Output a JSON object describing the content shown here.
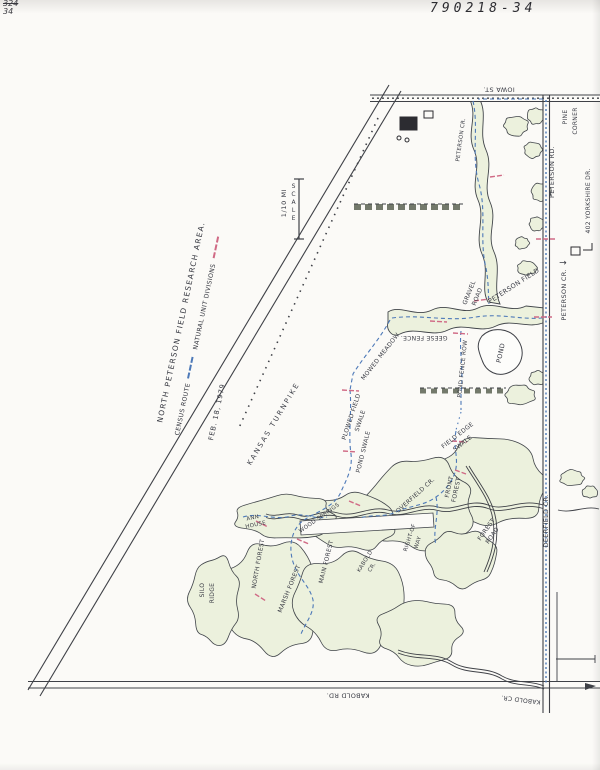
{
  "page": {
    "doc_number": "790218-34",
    "corner_note_line1": "324",
    "corner_note_line2": "34"
  },
  "title_block": {
    "title": "NORTH PETERSON FIELD RESEARCH AREA.",
    "legend": [
      {
        "label": "CENSUS ROUTE",
        "swatch": "census-route-dashed-blue"
      },
      {
        "label": "NATURAL UNIT DIVISIONS",
        "swatch": "natural-unit-dashed-red"
      }
    ],
    "date": "FEB. 18, 1979"
  },
  "scale": {
    "distance": "1/10 MI",
    "label": "SCALE"
  },
  "colors": {
    "census_route": "#4d79b8",
    "natural_unit": "#d06a85",
    "vegetation": "#ecf1dd",
    "ink": "#3f4147",
    "paper": "#fbfaf7"
  },
  "map_labels": [
    {
      "name": "kansas-turnpike-label",
      "text": "KANSAS TURNPIKE",
      "x": 274,
      "y": 424,
      "rot": -59,
      "size": 7,
      "ls": 2
    },
    {
      "name": "iowa-st-label",
      "text": "IOWA ST.",
      "x": 499,
      "y": 89,
      "rot": 180,
      "size": 6.5
    },
    {
      "name": "pine-corner-label-1",
      "text": "PINE",
      "x": 566,
      "y": 117,
      "rot": -90,
      "size": 6
    },
    {
      "name": "pine-corner-label-2",
      "text": "CORNER",
      "x": 576,
      "y": 121,
      "rot": -90,
      "size": 6
    },
    {
      "name": "peterson-rd-label",
      "text": "PETERSON RD.",
      "x": 552,
      "y": 172,
      "rot": -90,
      "size": 6.5
    },
    {
      "name": "yorkshire-address-label",
      "text": "402 YORKSHIRE DR.",
      "x": 589,
      "y": 201,
      "rot": -90,
      "size": 6
    },
    {
      "name": "peterson-cr-label",
      "text": "PETERSON CR.",
      "x": 564,
      "y": 295,
      "rot": -90,
      "size": 6.5
    },
    {
      "name": "peterson-cr-arrow",
      "text": "→",
      "x": 563,
      "y": 264,
      "rot": 0,
      "size": 9
    },
    {
      "name": "peterson-creek-upper-label",
      "text": "PETERSON CR.",
      "x": 462,
      "y": 140,
      "rot": -82,
      "size": 5.5
    },
    {
      "name": "peterson-field-label",
      "text": "PETERSON FIELD",
      "x": 514,
      "y": 286,
      "rot": -33,
      "size": 6.5
    },
    {
      "name": "gravel-road-label-1",
      "text": "GRAVEL",
      "x": 470,
      "y": 293,
      "rot": -68,
      "size": 6
    },
    {
      "name": "gravel-road-label-2",
      "text": "ROAD",
      "x": 478,
      "y": 297,
      "rot": -68,
      "size": 6
    },
    {
      "name": "geese-fence-label",
      "text": "GEESE FENCE.",
      "x": 424,
      "y": 337,
      "rot": 180,
      "size": 6
    },
    {
      "name": "mowed-meadow-label",
      "text": "MOWED MEADOW",
      "x": 381,
      "y": 357,
      "rot": -52,
      "size": 6
    },
    {
      "name": "pond-label",
      "text": "POND",
      "x": 501,
      "y": 353,
      "rot": -78,
      "size": 6.5
    },
    {
      "name": "pond-fence-row-label",
      "text": "POND FENCE ROW",
      "x": 464,
      "y": 369,
      "rot": -84,
      "size": 5.8
    },
    {
      "name": "plowed-field-swale-label-1",
      "text": "PLOWED FIELD",
      "x": 352,
      "y": 417,
      "rot": -72,
      "size": 6
    },
    {
      "name": "plowed-field-swale-label-2",
      "text": "SWALE",
      "x": 361,
      "y": 421,
      "rot": -72,
      "size": 6
    },
    {
      "name": "pond-swale-label",
      "text": "POND SWALE",
      "x": 364,
      "y": 452,
      "rot": -76,
      "size": 6
    },
    {
      "name": "field-edge-swale-label-1",
      "text": "FIELD EDGE",
      "x": 458,
      "y": 436,
      "rot": -38,
      "size": 6
    },
    {
      "name": "field-edge-swale-label-2",
      "text": "SWALE",
      "x": 463,
      "y": 444,
      "rot": -38,
      "size": 6
    },
    {
      "name": "front-forest-label-1",
      "text": "FRONT",
      "x": 450,
      "y": 487,
      "rot": -78,
      "size": 6
    },
    {
      "name": "front-forest-label-2",
      "text": "FOREST",
      "x": 457,
      "y": 490,
      "rot": -78,
      "size": 6
    },
    {
      "name": "overfield-cr-label",
      "text": "OVERFIELD CR.",
      "x": 416,
      "y": 496,
      "rot": -42,
      "size": 6
    },
    {
      "name": "right-of-way-label-1",
      "text": "RIGHT-OF",
      "x": 411,
      "y": 538,
      "rot": -72,
      "size": 5.5
    },
    {
      "name": "right-of-way-label-2",
      "text": "WAY",
      "x": 419,
      "y": 543,
      "rot": -72,
      "size": 5.5
    },
    {
      "name": "forest-road-label-1",
      "text": "FOREST",
      "x": 487,
      "y": 530,
      "rot": -55,
      "size": 6
    },
    {
      "name": "forest-road-label-2",
      "text": "ROAD",
      "x": 493,
      "y": 536,
      "rot": -55,
      "size": 6
    },
    {
      "name": "deerfield-cr-label",
      "text": "DEERFIELD CR.",
      "x": 546,
      "y": 521,
      "rot": -90,
      "size": 6.5
    },
    {
      "name": "kabold-cr-mid-label-1",
      "text": "KABOLD",
      "x": 366,
      "y": 562,
      "rot": -58,
      "size": 5.5
    },
    {
      "name": "kabold-cr-mid-label-2",
      "text": "CR.",
      "x": 373,
      "y": 568,
      "rot": -58,
      "size": 5.5
    },
    {
      "name": "ann-house-label-1",
      "text": "ANN",
      "x": 253,
      "y": 519,
      "rot": -12,
      "size": 5.5
    },
    {
      "name": "ann-house-label-2",
      "text": "HOUSE",
      "x": 256,
      "y": 526,
      "rot": -12,
      "size": 5.5
    },
    {
      "name": "wood-springs-label",
      "text": "WOOD SPRINGS",
      "x": 320,
      "y": 519,
      "rot": -35,
      "size": 5.5
    },
    {
      "name": "north-forest-label",
      "text": "NORTH FOREST",
      "x": 259,
      "y": 564,
      "rot": -80,
      "size": 6
    },
    {
      "name": "marsh-forest-label",
      "text": "MARSH FOREST",
      "x": 290,
      "y": 589,
      "rot": -68,
      "size": 6
    },
    {
      "name": "main-forest-label",
      "text": "MAIN FOREST",
      "x": 327,
      "y": 562,
      "rot": -76,
      "size": 6
    },
    {
      "name": "silo-ridge-label-1",
      "text": "SILO",
      "x": 203,
      "y": 590,
      "rot": -90,
      "size": 6
    },
    {
      "name": "silo-ridge-label-2",
      "text": "RIDGE",
      "x": 213,
      "y": 593,
      "rot": -90,
      "size": 6
    },
    {
      "name": "kabold-rd-label",
      "text": "KABOLD RD.",
      "x": 348,
      "y": 695,
      "rot": 180,
      "size": 6.5
    },
    {
      "name": "kabold-cr-corner-label",
      "text": "KABOLD CR.",
      "x": 521,
      "y": 699,
      "rot": 187,
      "size": 6
    }
  ]
}
